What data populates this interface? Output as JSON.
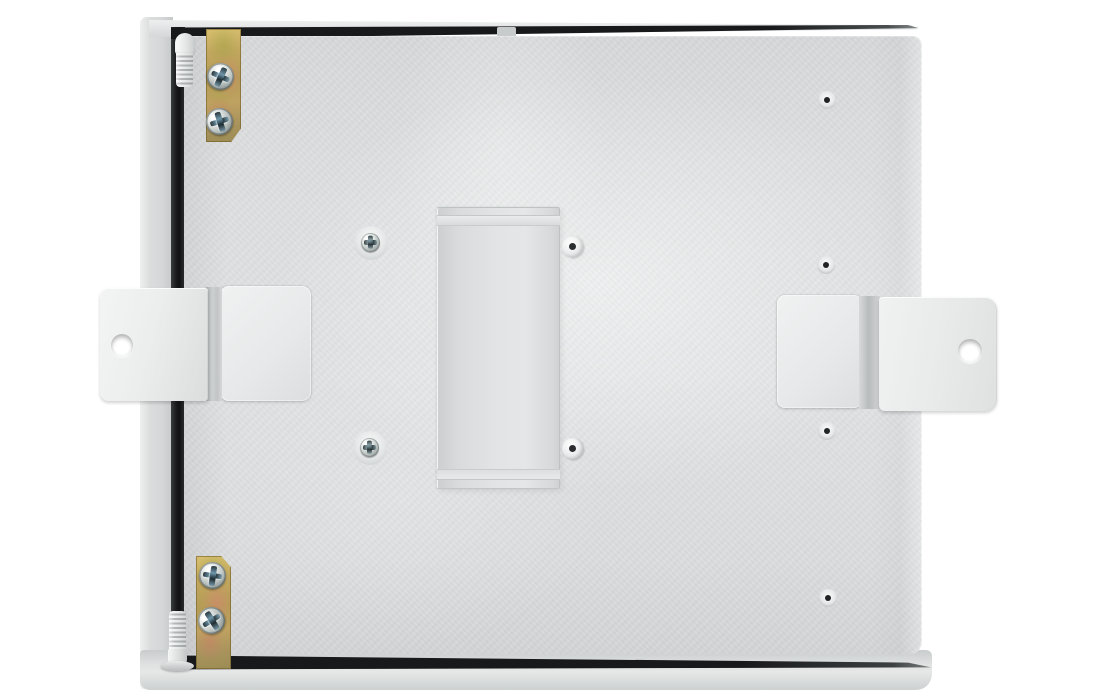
{
  "meta": {
    "type": "product-photo",
    "subject": "Rear view of a light-gray steel electrical enclosure with two brass hinge plates, two white wall-mount brackets and a central mounting channel",
    "width": 1093,
    "height": 700
  },
  "colors": {
    "background": "#ffffff",
    "panel_top": "#d6d8d9",
    "panel_base": "#e0e2e3",
    "panel_bottom": "#d2d4d5",
    "door_edge_light": "#eef0f0",
    "door_edge": "#d5d7d8",
    "door_edge_dark": "#c6c9c9",
    "gap_dark": "#17191a",
    "bracket_light": "#f0f2f2",
    "bracket_base": "#eceeee",
    "brass_light": "#d8c06f",
    "brass_base": "#b49c56",
    "brass_dark": "#9d8c55",
    "screw_silver": "#dfe4e2",
    "screw_shadow": "#5f6867",
    "screw_slot_teal": "#6e96aa",
    "pin_light": "#fafbfb",
    "pin_shadow": "#b5b9b9",
    "hole_dark": "#202425",
    "rivet_white": "#ffffff"
  },
  "enclosure": {
    "hinges": [
      {
        "position": "top-left",
        "screw_count": 2,
        "finish": "zinc-chromate brass"
      },
      {
        "position": "bottom-left",
        "screw_count": 2,
        "finish": "zinc-chromate brass"
      }
    ],
    "wall_brackets": [
      {
        "position": "left",
        "holes": 1
      },
      {
        "position": "right",
        "holes": 1
      }
    ],
    "din_bracket": {
      "position": "center",
      "orientation": "vertical"
    },
    "panel_screws": [
      {
        "x": 371,
        "y": 243
      },
      {
        "x": 370,
        "y": 448
      }
    ],
    "rivets": [
      {
        "x": 573,
        "y": 247
      },
      {
        "x": 573,
        "y": 449
      }
    ],
    "dimple_holes": [
      {
        "x": 827,
        "y": 100
      },
      {
        "x": 826,
        "y": 265
      },
      {
        "x": 827,
        "y": 431
      },
      {
        "x": 828,
        "y": 598
      }
    ]
  }
}
